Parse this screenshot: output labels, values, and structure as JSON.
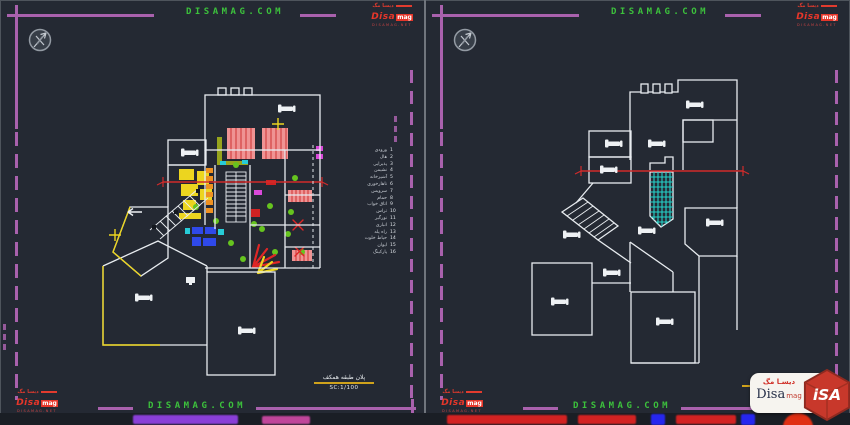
{
  "colors": {
    "background": "#242933",
    "frame_purple": "#a961ad",
    "site_green": "#3cc13c",
    "section_red": "#d22b2b",
    "highlight_yellow": "#ecd51f",
    "stair_cyan": "#25d2c9",
    "wall_white": "#e8ecf0"
  },
  "brand": {
    "mini_logo": {
      "fa": "ديسا مگ",
      "en": "Disa",
      "suffix": "mag",
      "site": "DISAMAG.NET"
    },
    "watermark": {
      "fa": "دیسـا مگ",
      "en": "Disa",
      "suffix": "mag",
      "cube": "iSA"
    }
  },
  "left_sheet": {
    "header_site": "DISAMAG.COM",
    "footer_site": "DISAMAG.COM",
    "title_block": {
      "title": "پلان طبقه همکف",
      "scale": "SC:1/100"
    },
    "legend": {
      "rows": [
        {
          "num": "1",
          "label": "ورودی"
        },
        {
          "num": "2",
          "label": "هال"
        },
        {
          "num": "3",
          "label": "پذیرایی"
        },
        {
          "num": "4",
          "label": "نشیمن"
        },
        {
          "num": "5",
          "label": "آشپزخانه"
        },
        {
          "num": "6",
          "label": "ناهارخوری"
        },
        {
          "num": "7",
          "label": "سرویس"
        },
        {
          "num": "8",
          "label": "حمام"
        },
        {
          "num": "9",
          "label": "اتاق خواب"
        },
        {
          "num": "10",
          "label": "تراس"
        },
        {
          "num": "11",
          "label": "نورگیر"
        },
        {
          "num": "12",
          "label": "انباری"
        },
        {
          "num": "13",
          "label": "راه پله"
        },
        {
          "num": "14",
          "label": "حیاط خلوت"
        },
        {
          "num": "15",
          "label": "ایوان"
        },
        {
          "num": "16",
          "label": "پارکینگ"
        }
      ]
    }
  },
  "right_sheet": {
    "header_site": "DISAMAG.COM",
    "footer_site": "DISAMAG.COM"
  }
}
